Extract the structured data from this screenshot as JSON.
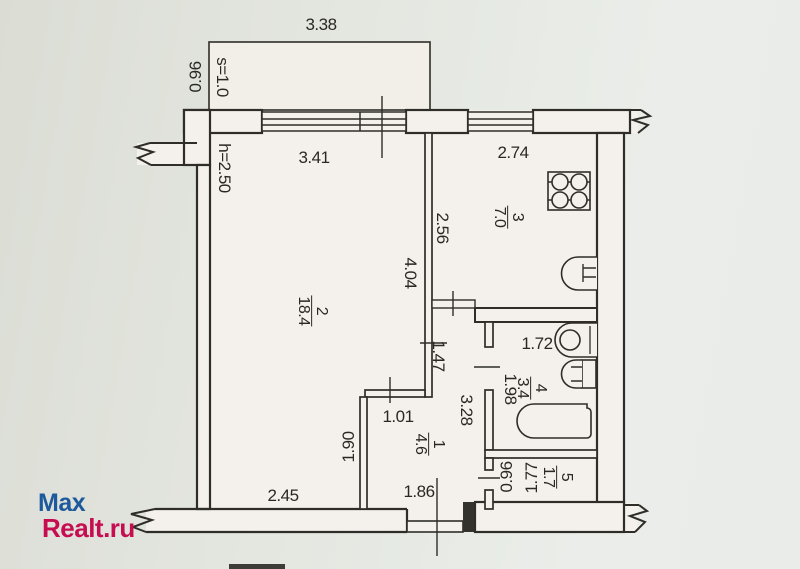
{
  "watermark": {
    "line1": "Max",
    "line2": "Realt.ru",
    "color_line1": "#1d5a9b",
    "color_line2": "#c60d52"
  },
  "floor_plan": {
    "rooms": [
      {
        "number": "1",
        "area": "4.6"
      },
      {
        "number": "2",
        "area": "18.4"
      },
      {
        "number": "3",
        "area": "7.0"
      },
      {
        "number": "4",
        "area": "3.4"
      },
      {
        "number": "5",
        "area": "1.7"
      }
    ],
    "dimensions": {
      "balcony_width": "3.38",
      "balcony_s": "s=1.0",
      "balcony_depth": "0.96",
      "ceiling_height": "h=2.50",
      "room2_width": "3.41",
      "kitchen_width": "2.74",
      "kitchen_depth": "2.56",
      "room2_depth": "4.04",
      "corridor_length": "1.47",
      "bath_width": "1.72",
      "bath_depth": "1.98",
      "hall_depth": "3.28",
      "partition_width": "1.01",
      "room2_right_depth": "1.90",
      "room2_bottom_width": "2.45",
      "hall_width": "1.86",
      "storage_depth": "0.96",
      "storage_width": "1.77"
    },
    "fixtures": [
      "stove",
      "kitchen-sink",
      "washbasin",
      "toilet",
      "bathtub"
    ]
  }
}
